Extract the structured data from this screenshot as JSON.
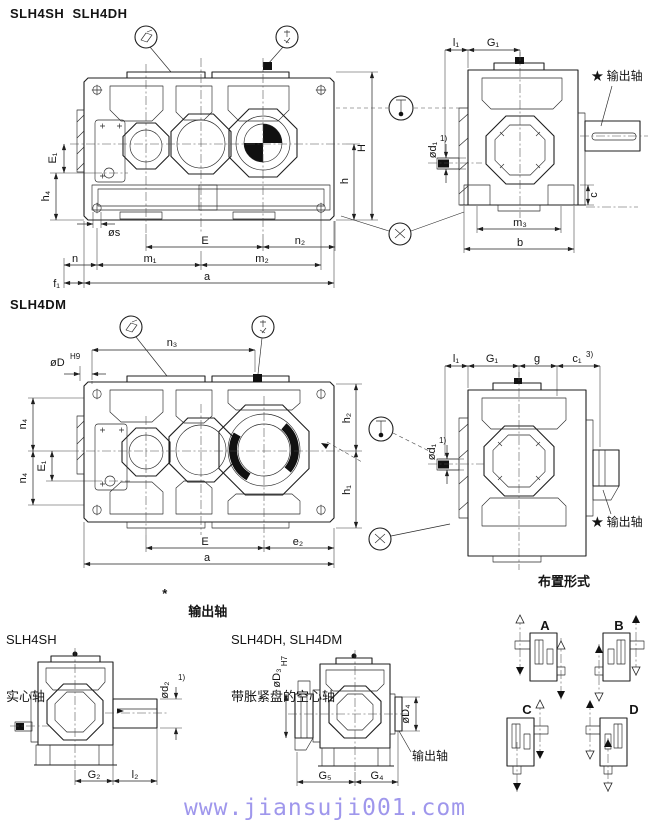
{
  "titles": {
    "models_top": "SLH4SH  SLH4DH",
    "model_mid": "SLH4DM",
    "arrangement": "布置形式",
    "footer_url": "www.jiansuji001.com"
  },
  "legend": {
    "star": "*",
    "output_shaft": "输出轴",
    "sh_model": "SLH4SH",
    "sh_type": "实心轴",
    "dm_models": "SLH4DH, SLH4DM",
    "dm_type": "带胀紧盘的空心轴"
  },
  "colors": {
    "line": "#1f1f1f",
    "footer_url": "#9f97ec",
    "paper": "#ffffff"
  },
  "icons": {
    "balloon_left": "oil-fill",
    "balloon_right": "breather-plug",
    "circle_upper": "oil-level-dipstick",
    "circle_lower": "oil-drain-plug",
    "port_mark": "centroid-mark"
  },
  "v1": {
    "E1": "E₁",
    "h4": "h₄",
    "s": "øs",
    "E": "E",
    "n2": "n₂",
    "n": "n",
    "m1": "m₁",
    "m2": "m₂",
    "f1": "f₁",
    "a": "a",
    "h": "h",
    "H": "H"
  },
  "e1": {
    "l1": "l₁",
    "G1": "G₁",
    "output": "★ 输出轴",
    "d1": "ød₁",
    "note1": "1)",
    "m3": "m₃",
    "b": "b",
    "c": "c"
  },
  "v2": {
    "n3": "n₃",
    "D": "øD",
    "D_tol": "H9",
    "n4": "n₄",
    "E1": "E₁",
    "h2": "h₂",
    "h1": "h₁",
    "E": "E",
    "e2": "e₂",
    "a": "a"
  },
  "e2": {
    "l1": "l₁",
    "G1": "G₁",
    "g": "g",
    "c1": "c₁",
    "note3": "3)",
    "d1": "ød₁",
    "note1": "1)",
    "output": "★ 输出轴"
  },
  "s1": {
    "d2": "ød₂",
    "note1": "1)",
    "G2": "G₂",
    "l2": "l₂"
  },
  "s2": {
    "D3": "øD₃",
    "D3_tol": "H7",
    "D4": "øD₄",
    "G5": "G₅",
    "G4": "G₄",
    "output": "输出轴"
  },
  "arr": {
    "A": "A",
    "B": "B",
    "C": "C",
    "D": "D"
  }
}
